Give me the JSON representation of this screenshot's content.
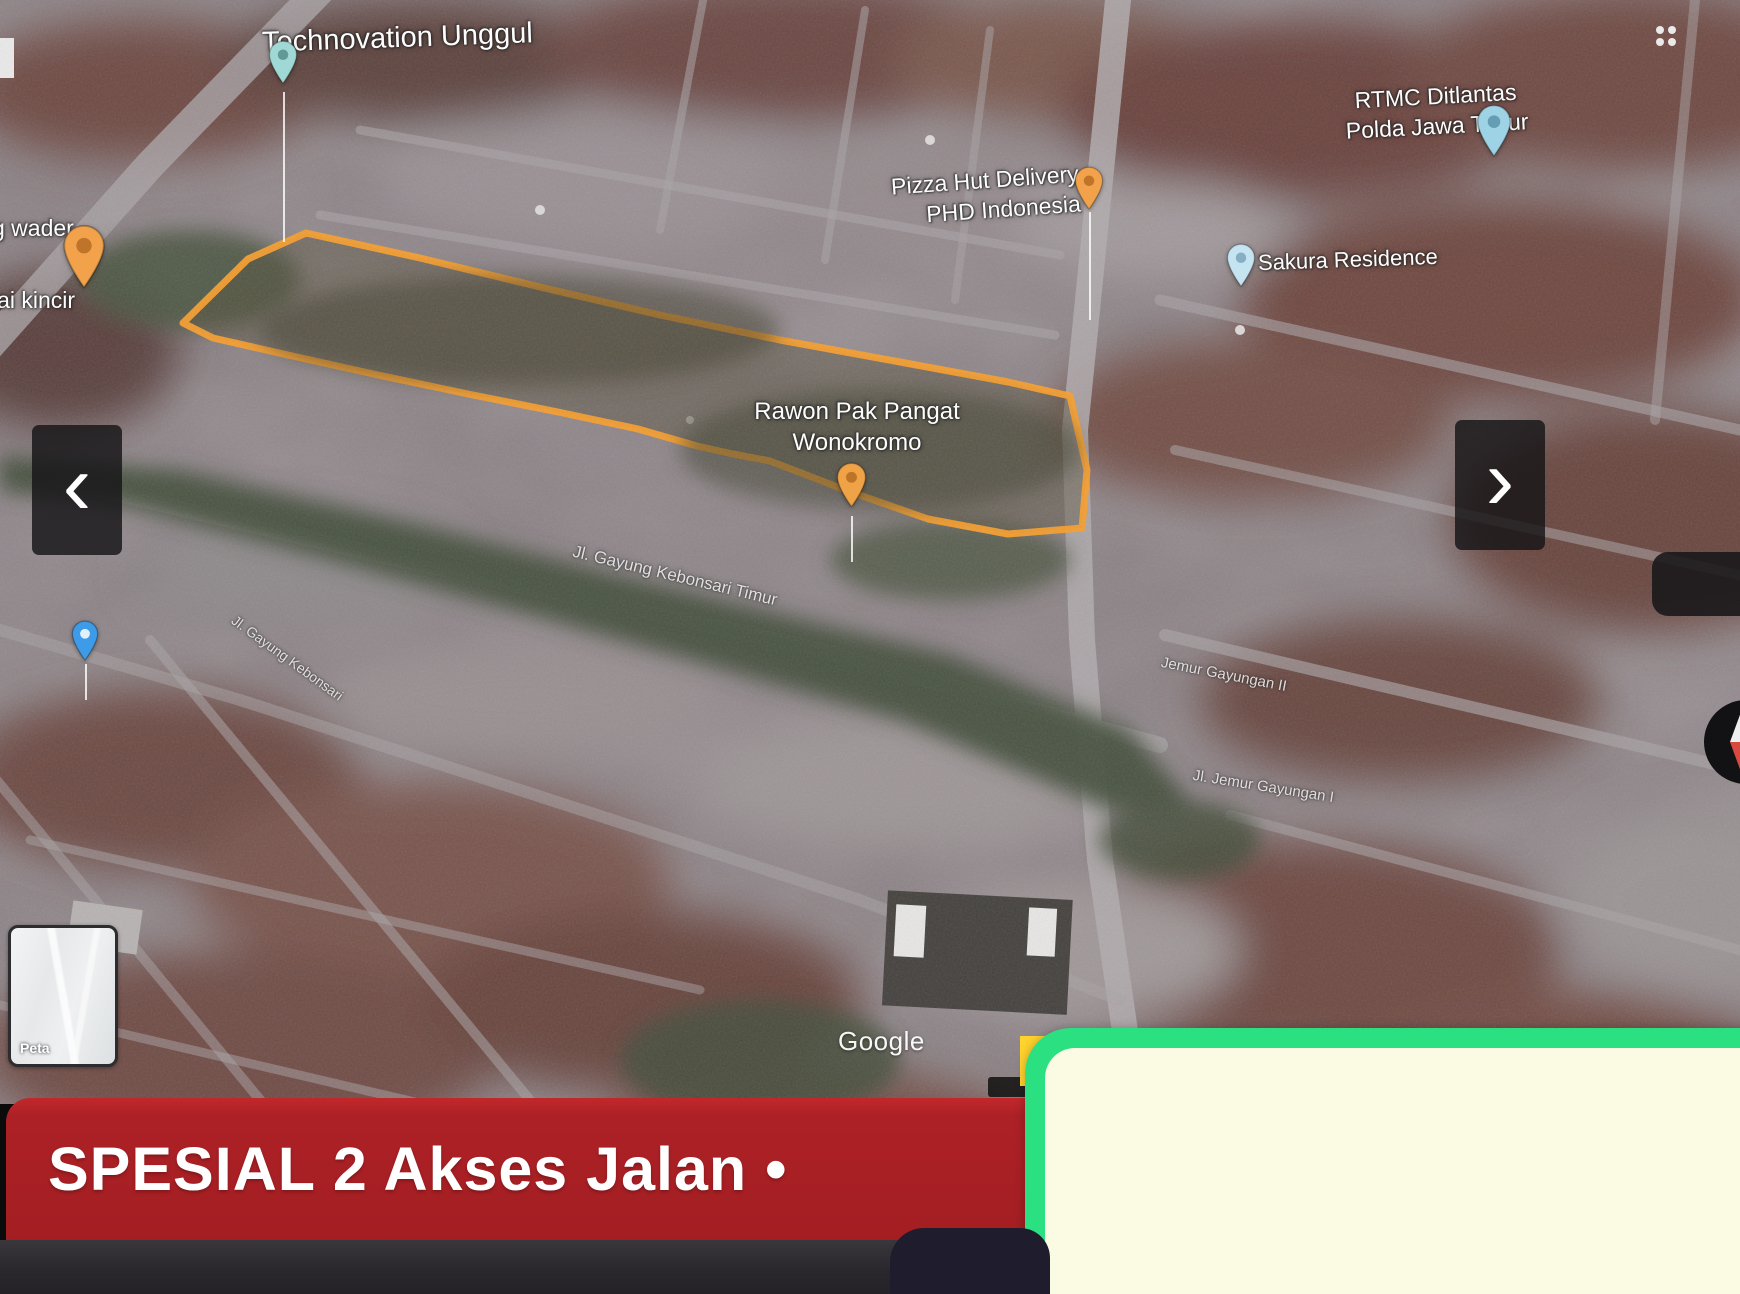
{
  "banner": {
    "text": "SPESIAL 2 Akses Jalan •",
    "bg_color": "#A82025",
    "text_color": "#FFFFFF"
  },
  "nav": {
    "prev_glyph": "‹",
    "next_glyph": "›"
  },
  "card": {
    "border_color": "#2BE081",
    "fill_color": "#FBFAE3",
    "accent_color": "#FFD22E"
  },
  "colors": {
    "parcel_outline": "#F59E2D"
  },
  "map": {
    "attribution": "Google",
    "map_type_label": "Peta",
    "poi": {
      "technovation": {
        "name": "Technovation Unggul"
      },
      "pizza_hut": {
        "line1": "Pizza Hut Delivery",
        "line2": "PHD Indonesia"
      },
      "rtmc": {
        "line1": "RTMC Ditlantas",
        "line2": "Polda Jawa Timur"
      },
      "sakura": {
        "name": "Sakura Residence"
      },
      "warung_wader": {
        "line1": "g wader",
        "line2": "lai kincir"
      },
      "rawon": {
        "line1": "Rawon Pak Pangat",
        "line2": "Wonokromo"
      }
    },
    "streets": {
      "s1": "Jl. Gayung Kebonsari Timur",
      "s2": "Jl. Gayung Kebonsari",
      "s3": "Jemur Gayungan II",
      "s4": "Jl. Jemur Gayungan I"
    }
  }
}
